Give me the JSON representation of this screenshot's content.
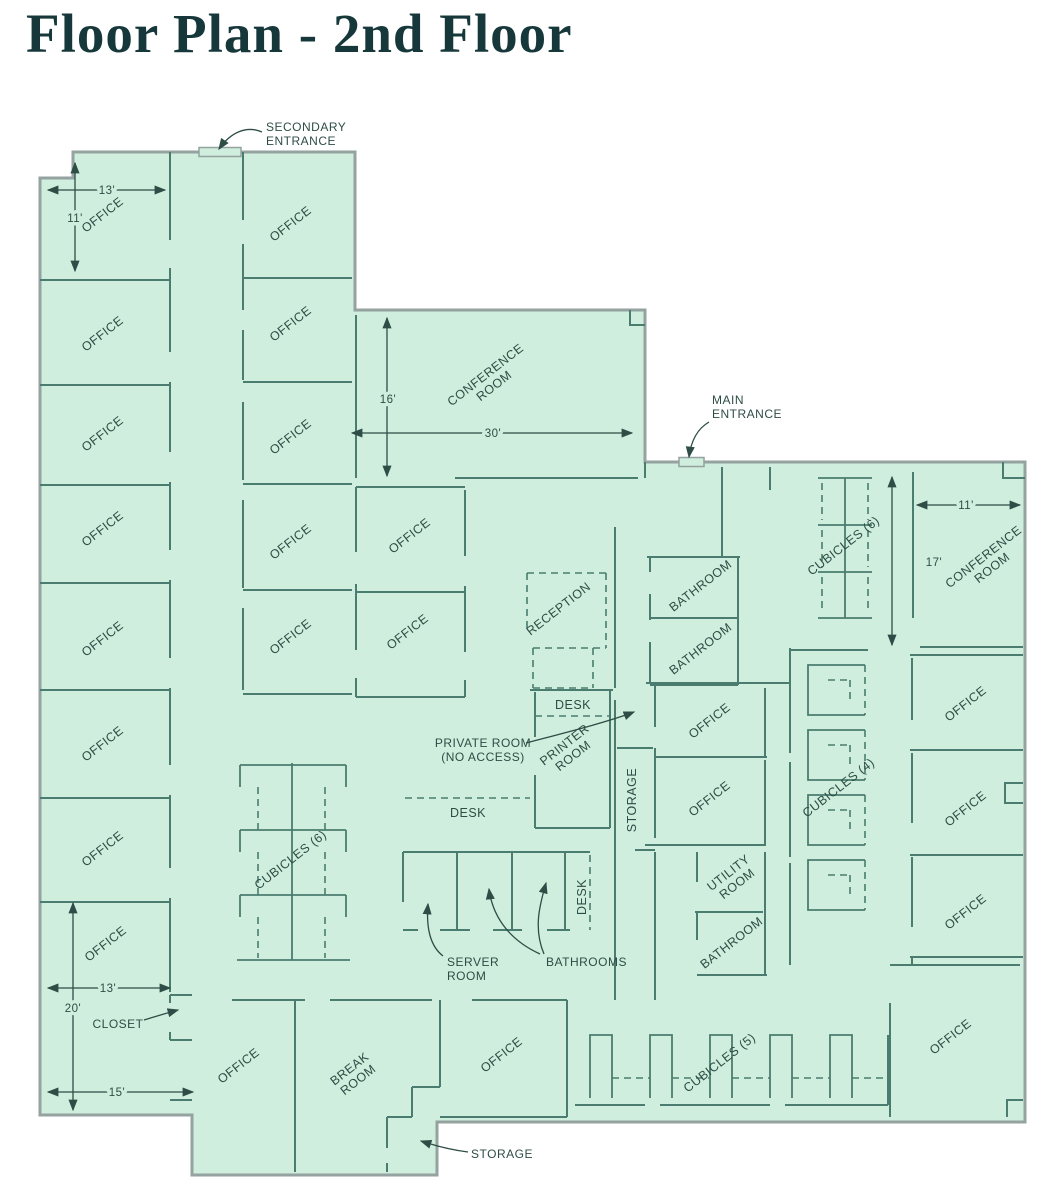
{
  "title": "Floor Plan - 2nd Floor",
  "colors": {
    "floor": "#cfeedd",
    "outer": "#94a2a0",
    "wall": "#4a7d6f",
    "ink": "#2e4d46",
    "title": "#17383b"
  },
  "plan": {
    "labels": [
      {
        "t": "OFFICE",
        "x": 105,
        "y": 218,
        "r": -38,
        "k": "room"
      },
      {
        "t": "OFFICE",
        "x": 105,
        "y": 337,
        "r": -38,
        "k": "room"
      },
      {
        "t": "OFFICE",
        "x": 105,
        "y": 437,
        "r": -38,
        "k": "room"
      },
      {
        "t": "OFFICE",
        "x": 105,
        "y": 532,
        "r": -38,
        "k": "room"
      },
      {
        "t": "OFFICE",
        "x": 105,
        "y": 642,
        "r": -38,
        "k": "room"
      },
      {
        "t": "OFFICE",
        "x": 105,
        "y": 747,
        "r": -38,
        "k": "room"
      },
      {
        "t": "OFFICE",
        "x": 105,
        "y": 852,
        "r": -38,
        "k": "room"
      },
      {
        "t": "OFFICE",
        "x": 108,
        "y": 947,
        "r": -38,
        "k": "room"
      },
      {
        "t": "OFFICE",
        "x": 293,
        "y": 227,
        "r": -38,
        "k": "room"
      },
      {
        "t": "OFFICE",
        "x": 293,
        "y": 327,
        "r": -38,
        "k": "room"
      },
      {
        "t": "OFFICE",
        "x": 293,
        "y": 440,
        "r": -38,
        "k": "room"
      },
      {
        "t": "OFFICE",
        "x": 293,
        "y": 545,
        "r": -38,
        "k": "room"
      },
      {
        "t": "OFFICE",
        "x": 293,
        "y": 640,
        "r": -38,
        "k": "room"
      },
      {
        "t": "OFFICE",
        "x": 412,
        "y": 539,
        "r": -38,
        "k": "room"
      },
      {
        "t": "OFFICE",
        "x": 410,
        "y": 635,
        "r": -38,
        "k": "room"
      },
      {
        "lines": [
          "CONFERENCE",
          "ROOM"
        ],
        "x": 488,
        "y": 378,
        "r": -38,
        "k": "room"
      },
      {
        "t": "RECEPTION",
        "x": 561,
        "y": 612,
        "r": -38,
        "k": "room"
      },
      {
        "t": "DESK",
        "x": 573,
        "y": 709,
        "k": "room"
      },
      {
        "t": "DESK",
        "x": 468,
        "y": 817,
        "k": "room"
      },
      {
        "t": "DESK",
        "x": 586,
        "y": 897,
        "r": -90,
        "k": "room"
      },
      {
        "t": "STORAGE",
        "x": 636,
        "y": 800,
        "r": -90,
        "k": "room"
      },
      {
        "lines": [
          "PRINTER",
          "ROOM"
        ],
        "x": 567,
        "y": 748,
        "r": -38,
        "k": "room"
      },
      {
        "t": "BATHROOM",
        "x": 703,
        "y": 589,
        "r": -38,
        "k": "room"
      },
      {
        "t": "BATHROOM",
        "x": 703,
        "y": 652,
        "r": -38,
        "k": "room"
      },
      {
        "t": "OFFICE",
        "x": 712,
        "y": 724,
        "r": -38,
        "k": "room"
      },
      {
        "t": "OFFICE",
        "x": 712,
        "y": 802,
        "r": -38,
        "k": "room"
      },
      {
        "lines": [
          "UTILITY",
          "ROOM"
        ],
        "x": 731,
        "y": 876,
        "r": -38,
        "k": "room"
      },
      {
        "t": "BATHROOM",
        "x": 734,
        "y": 946,
        "r": -38,
        "k": "room"
      },
      {
        "t": "CUBICLES (6)",
        "x": 846,
        "y": 549,
        "r": -38,
        "k": "room"
      },
      {
        "t": "CUBICLES (4)",
        "x": 841,
        "y": 791,
        "r": -38,
        "k": "room"
      },
      {
        "t": "CUBICLES (6)",
        "x": 293,
        "y": 863,
        "r": -38,
        "k": "room"
      },
      {
        "t": "CUBICLES (5)",
        "x": 722,
        "y": 1066,
        "r": -38,
        "k": "room"
      },
      {
        "lines": [
          "CONFERENCE",
          "ROOM"
        ],
        "x": 986,
        "y": 560,
        "r": -38,
        "k": "room"
      },
      {
        "t": "OFFICE",
        "x": 968,
        "y": 707,
        "r": -38,
        "k": "room"
      },
      {
        "t": "OFFICE",
        "x": 968,
        "y": 812,
        "r": -38,
        "k": "room"
      },
      {
        "t": "OFFICE",
        "x": 968,
        "y": 915,
        "r": -38,
        "k": "room"
      },
      {
        "t": "OFFICE",
        "x": 953,
        "y": 1040,
        "r": -38,
        "k": "room"
      },
      {
        "t": "OFFICE",
        "x": 241,
        "y": 1069,
        "r": -38,
        "k": "room"
      },
      {
        "lines": [
          "BREAK",
          "ROOM"
        ],
        "x": 352,
        "y": 1072,
        "r": -38,
        "k": "room"
      },
      {
        "t": "OFFICE",
        "x": 504,
        "y": 1058,
        "r": -38,
        "k": "room"
      },
      {
        "t": "13'",
        "x": 107,
        "y": 194,
        "k": "dim",
        "n": "dim-13ft-top"
      },
      {
        "t": "11'",
        "x": 75,
        "y": 222,
        "k": "dim",
        "n": "dim-11ft-left"
      },
      {
        "t": "16'",
        "x": 388,
        "y": 403,
        "k": "dim",
        "n": "dim-16ft"
      },
      {
        "t": "30'",
        "x": 493,
        "y": 437,
        "k": "dim",
        "n": "dim-30ft"
      },
      {
        "t": "11'",
        "x": 966,
        "y": 509,
        "k": "dim",
        "n": "dim-11ft-right"
      },
      {
        "t": "17'",
        "x": 934,
        "y": 566,
        "k": "dim",
        "n": "dim-17ft"
      },
      {
        "t": "20'",
        "x": 73,
        "y": 1012,
        "k": "dim",
        "n": "dim-20ft"
      },
      {
        "t": "13'",
        "x": 108,
        "y": 992,
        "k": "dim",
        "n": "dim-13ft-bottom"
      },
      {
        "t": "15'",
        "x": 117,
        "y": 1096,
        "k": "dim",
        "n": "dim-15ft"
      },
      {
        "lines": [
          "SECONDARY",
          "ENTRANCE"
        ],
        "x": 266,
        "y": 131,
        "a": "start",
        "k": "note",
        "n": "note-secondary-entrance"
      },
      {
        "lines": [
          "MAIN",
          "ENTRANCE"
        ],
        "x": 712,
        "y": 404,
        "a": "start",
        "k": "note",
        "n": "note-main-entrance"
      },
      {
        "lines": [
          "PRIVATE ROOM",
          "(NO ACCESS)"
        ],
        "x": 483,
        "y": 747,
        "k": "note",
        "n": "note-private-room"
      },
      {
        "lines": [
          "SERVER",
          "ROOM"
        ],
        "x": 447,
        "y": 966,
        "a": "start",
        "k": "note",
        "n": "note-server-room"
      },
      {
        "t": "BATHROOMS",
        "x": 546,
        "y": 966,
        "a": "start",
        "k": "note",
        "n": "note-bathrooms"
      },
      {
        "t": "STORAGE",
        "x": 471,
        "y": 1158,
        "a": "start",
        "k": "note",
        "n": "note-storage"
      },
      {
        "t": "CLOSET",
        "x": 118,
        "y": 1028,
        "k": "note",
        "n": "note-closet"
      }
    ]
  }
}
